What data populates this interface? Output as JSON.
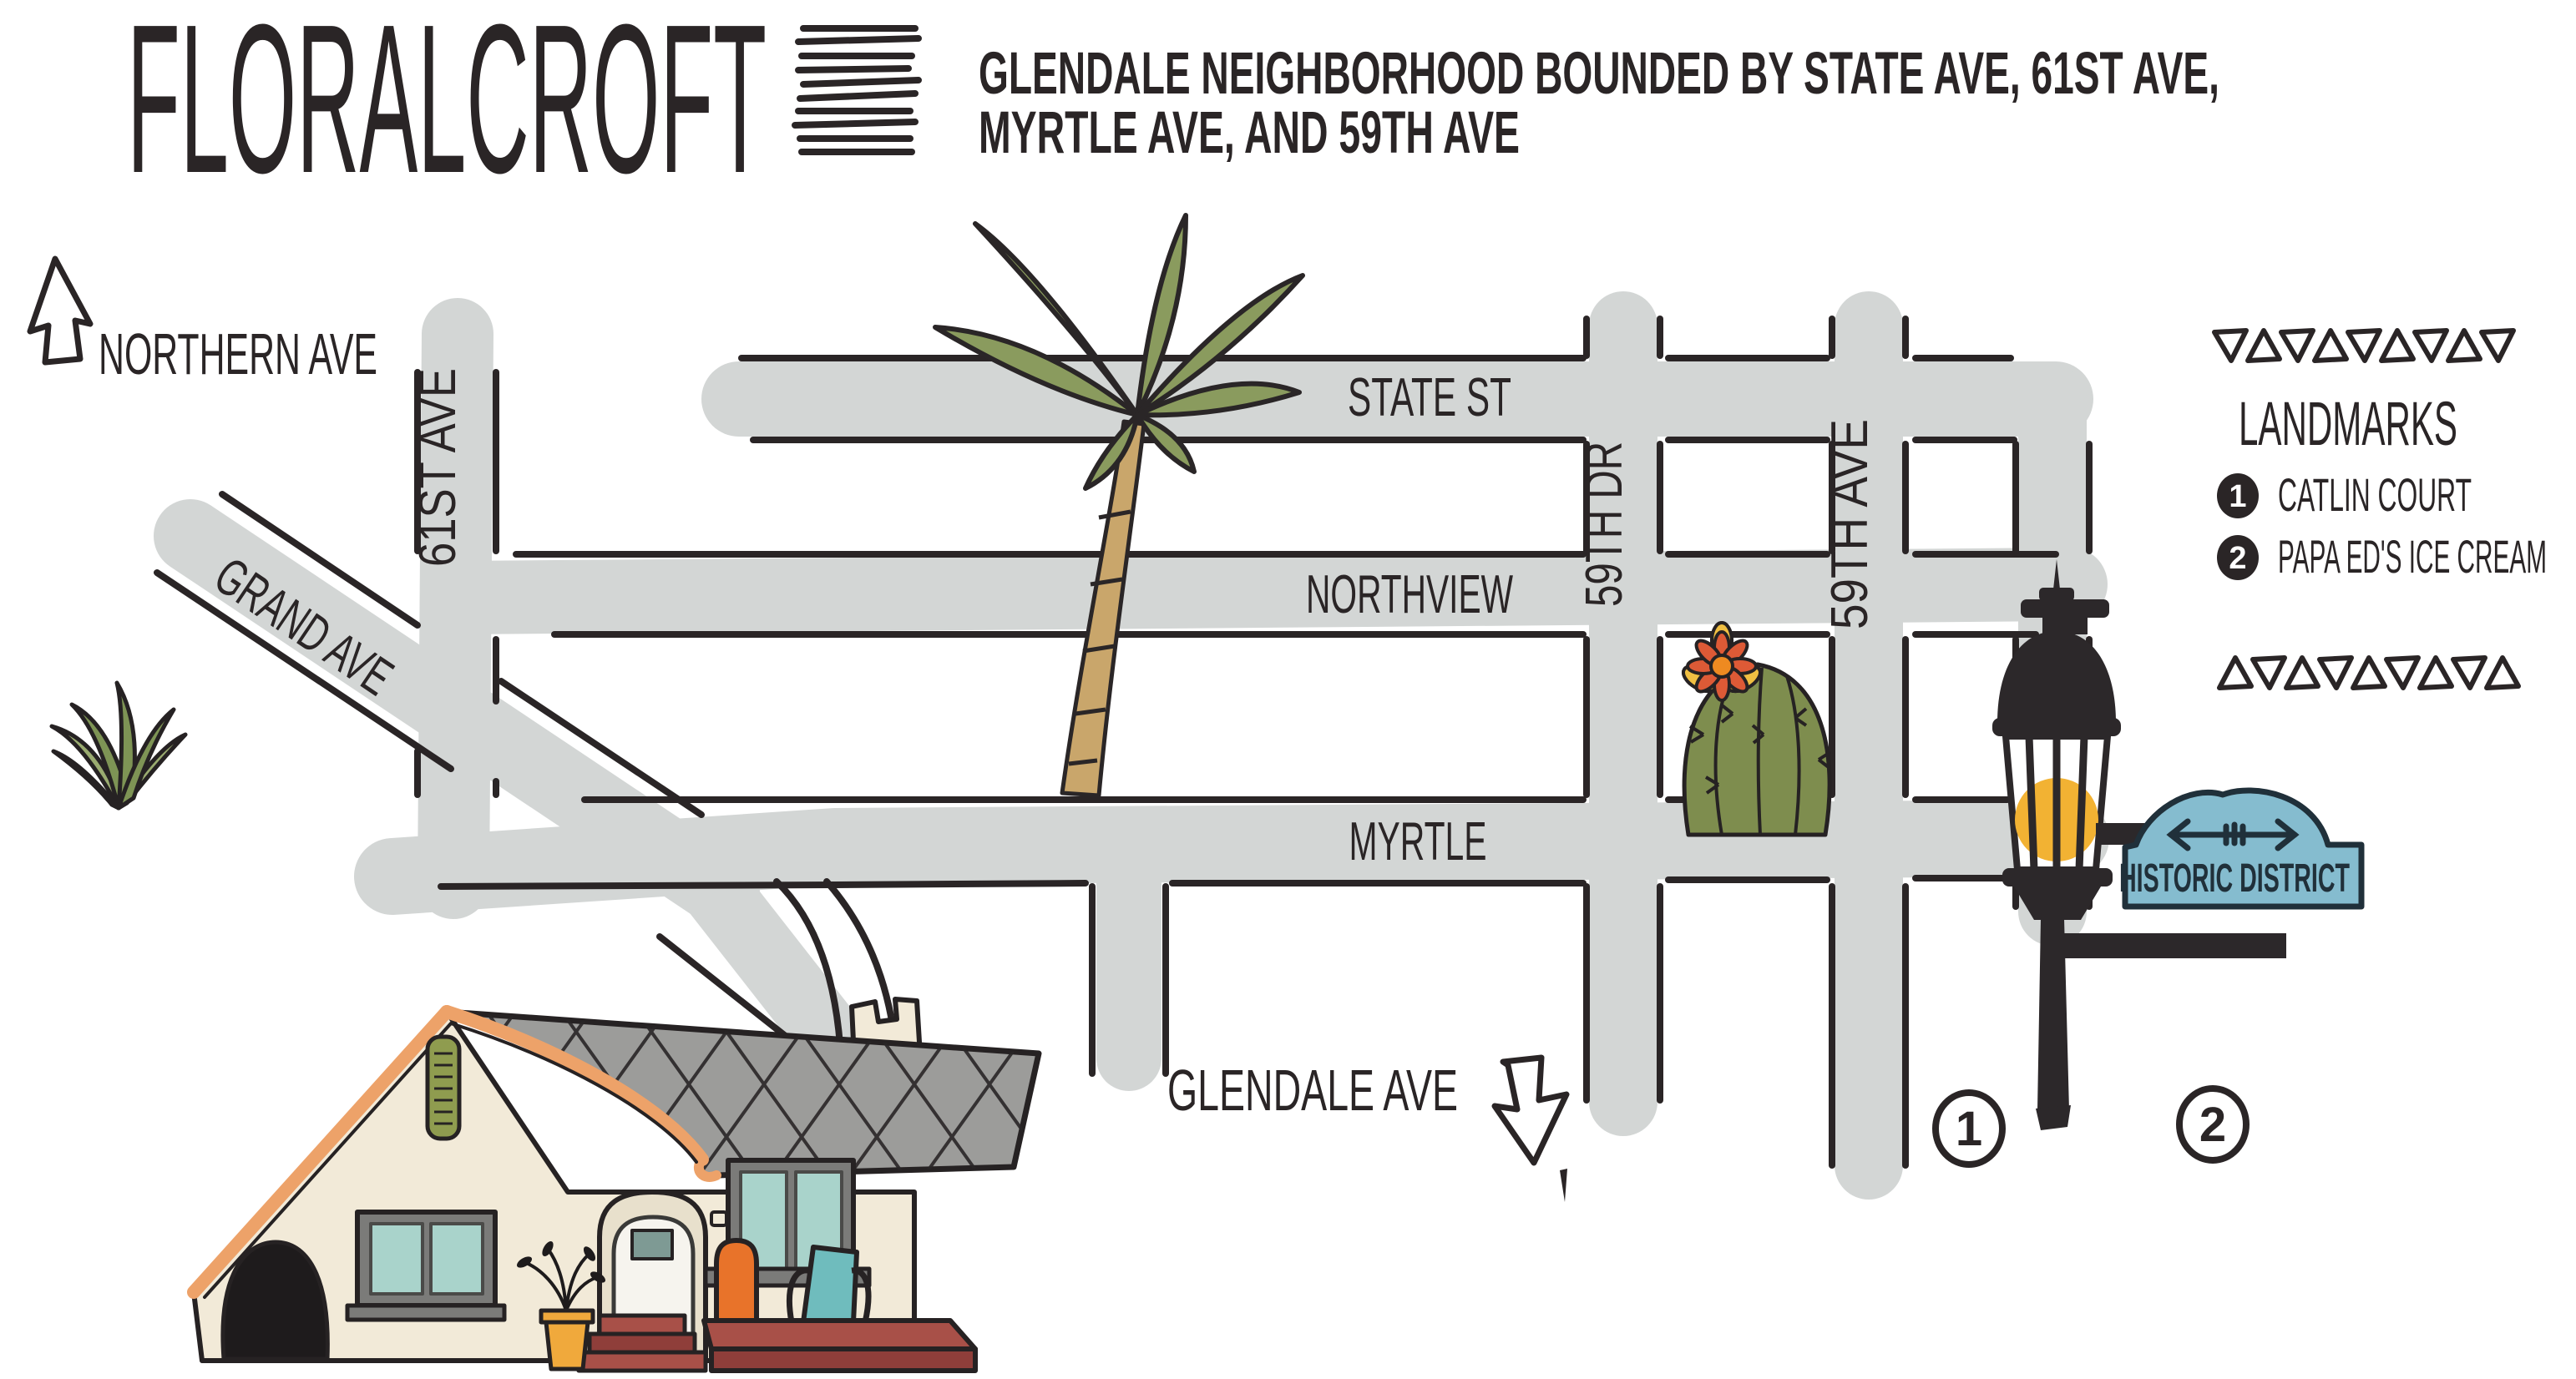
{
  "header": {
    "title": "FLORALCROFT",
    "subtitle_line1": "GLENDALE NEIGHBORHOOD BOUNDED BY STATE AVE, 61ST AVE,",
    "subtitle_line2": "MYRTLE AVE, AND 59TH AVE"
  },
  "map": {
    "north_arrow_label": "NORTHERN AVE",
    "streets": {
      "grand": "GRAND AVE",
      "sixty_first": "61ST AVE",
      "state": "STATE ST",
      "northview": "NORTHVIEW",
      "myrtle": "MYRTLE",
      "fifty_ninth_dr": "59TH DR",
      "fifty_ninth_ave": "59TH AVE",
      "glendale": "GLENDALE AVE"
    },
    "historic_sign": "HISTORIC DISTRICT",
    "marker_1": "1",
    "marker_2": "2"
  },
  "legend": {
    "title": "LANDMARKS",
    "items": [
      {
        "number": "1",
        "label": "CATLIN COURT"
      },
      {
        "number": "2",
        "label": "PAPA ED'S ICE CREAM"
      }
    ]
  },
  "colors": {
    "road_gray": "#d3d6d5",
    "ink": "#2a2526",
    "sign_blue": "#85bccf",
    "lamp_yellow": "#f2b233",
    "palm_green": "#8a9b5e",
    "cactus_green": "#7e8d4e",
    "house_cream": "#f2ead8",
    "roof_gray": "#9c9c9a",
    "trim_orange": "#eda269",
    "porch_red": "#a85048",
    "window_teal": "#a9d3cb"
  }
}
